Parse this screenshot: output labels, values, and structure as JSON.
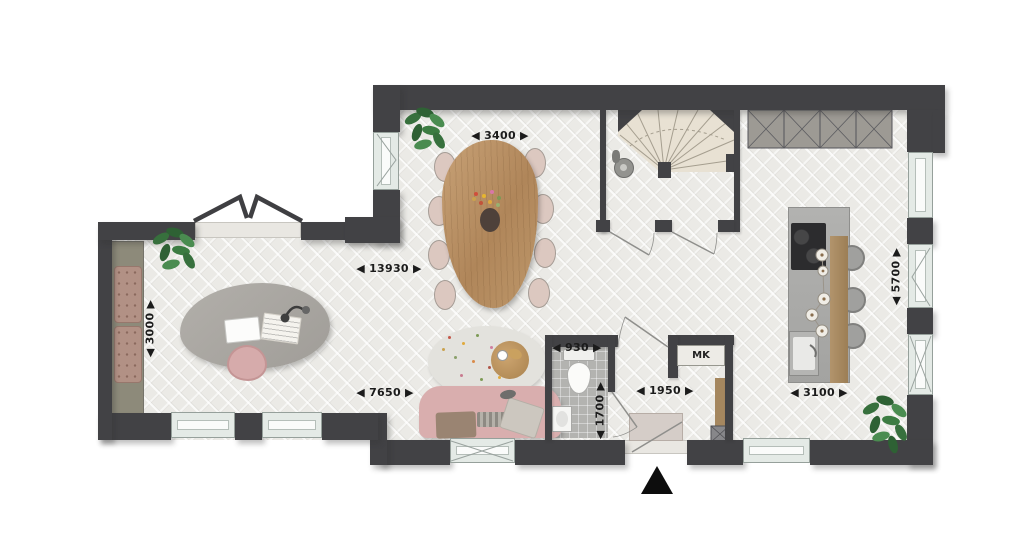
{
  "plan": {
    "type": "residential-floor-plan",
    "dim_labels": [
      {
        "id": "dining-width",
        "text": "◀ 3400 ▶"
      },
      {
        "id": "overall-width",
        "text": "◀ 13930 ▶"
      },
      {
        "id": "study-depth",
        "text": "◀ 3000 ▶"
      },
      {
        "id": "living-width",
        "text": "◀ 7650 ▶"
      },
      {
        "id": "wc-width",
        "text": "◀ 930 ▶"
      },
      {
        "id": "wc-depth",
        "text": "◀ 1700 ▶"
      },
      {
        "id": "hall-width",
        "text": "◀ 1950 ▶"
      },
      {
        "id": "kitchen-width",
        "text": "◀ 3100 ▶"
      },
      {
        "id": "kitchen-depth",
        "text": "◀ 5700 ▶"
      }
    ],
    "rooms": {
      "meter_closet_label": "MK"
    },
    "colors": {
      "wall": "#424245",
      "floor": "#ebeae6",
      "tile": "#b3b3b0",
      "window_frame": "#e4eae6",
      "stairs": "#e8e1d3",
      "bench_cushion": "#b29185",
      "label_text": "#1b1b1b"
    }
  }
}
